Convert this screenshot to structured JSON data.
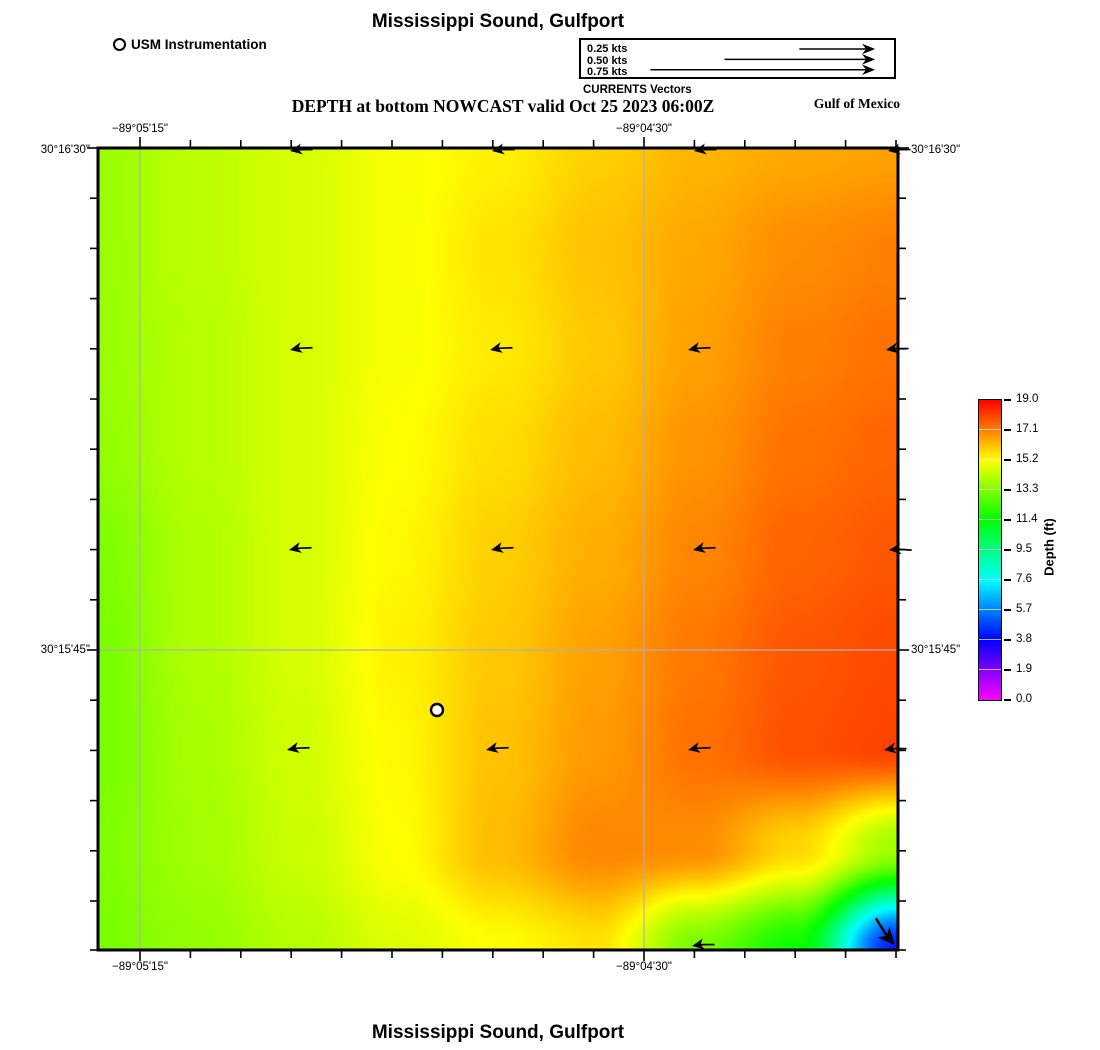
{
  "figure": {
    "title_top": "Mississippi Sound, Gulfport",
    "title_bottom": "Mississippi Sound, Gulfport",
    "nowcast_title": "DEPTH at bottom NOWCAST valid Oct 25 2023 06:00Z",
    "region_label": "Gulf of Mexico"
  },
  "instrumentation_legend": {
    "label": "USM Instrumentation",
    "marker": "open-circle-icon"
  },
  "currents_legend": {
    "caption": "CURRENTS Vectors",
    "items": [
      {
        "label": "0.25 kts",
        "arrow_length_px": 84
      },
      {
        "label": "0.50 kts",
        "arrow_length_px": 167
      },
      {
        "label": "0.75 kts",
        "arrow_length_px": 249
      }
    ]
  },
  "axes": {
    "top": [
      {
        "text": "−89°05'15\"",
        "x": 140
      },
      {
        "text": "−89°04'30\"",
        "x": 644
      }
    ],
    "bottom": [
      {
        "text": "−89°05'15\"",
        "x": 140
      },
      {
        "text": "−89°04'30\"",
        "x": 644
      }
    ],
    "left": [
      {
        "text": "30°16'30\"",
        "y": 150
      },
      {
        "text": "30°15'45\"",
        "y": 650
      }
    ],
    "right": [
      {
        "text": "30°16'30\"",
        "y": 150
      },
      {
        "text": "30°15'45\"",
        "y": 650
      }
    ]
  },
  "colorbar": {
    "label": "Depth (ft)",
    "min": 0,
    "max": 19,
    "tick_labels": [
      "19.0",
      "17.1",
      "15.2",
      "13.3",
      "11.4",
      "9.5",
      "7.6",
      "5.7",
      "3.8",
      "1.9",
      "0.0"
    ],
    "colormap": "rainbow: magenta(0) - blue(3.8) - cyan(7.6) - green(11.4) - yellow(15.2) - red(19.0)"
  },
  "chart_data": {
    "type": "heatmap",
    "title": "Mississippi Sound, Gulfport",
    "subtitle": "DEPTH at bottom NOWCAST valid Oct 25 2023 06:00Z",
    "units": "ft",
    "value_range": [
      0,
      19
    ],
    "depth_grid_ft": [
      [
        13.7,
        14.2,
        14.6,
        15.1,
        15.4,
        15.9,
        16.3,
        16.5,
        16.6
      ],
      [
        13.7,
        14.2,
        14.6,
        15.1,
        15.6,
        16.1,
        16.5,
        16.9,
        17.1
      ],
      [
        13.7,
        14.1,
        14.6,
        15.1,
        15.5,
        16.0,
        16.6,
        17.1,
        17.3
      ],
      [
        13.6,
        14.1,
        14.6,
        15.2,
        15.7,
        16.2,
        16.8,
        17.3,
        17.5
      ],
      [
        13.3,
        14.0,
        14.6,
        15.3,
        15.9,
        16.4,
        17.0,
        17.5,
        17.7
      ],
      [
        13.2,
        14.0,
        14.6,
        15.4,
        16.0,
        16.6,
        17.2,
        17.7,
        17.9
      ],
      [
        13.2,
        13.9,
        14.5,
        15.3,
        16.1,
        16.7,
        17.3,
        17.8,
        18.0
      ],
      [
        13.3,
        13.8,
        14.4,
        15.2,
        16.2,
        17.0,
        16.9,
        15.8,
        13.8
      ],
      [
        13.2,
        13.6,
        14.1,
        14.7,
        15.2,
        15.6,
        13.2,
        11.6,
        4.2
      ]
    ],
    "grid_rows_north_to_south": true,
    "station": {
      "name": "USM Instrumentation",
      "x_px": 339,
      "y_px": 562
    },
    "current_vectors": {
      "flow_direction": "westward (arrows point left); southeastward at bottom-right corner",
      "arrows": [
        [
          192,
          3,
          170,
          1
        ],
        [
          394,
          3,
          170,
          1
        ],
        [
          596,
          3,
          170,
          1
        ],
        [
          790,
          3,
          170,
          1
        ],
        [
          192,
          202,
          168,
          1
        ],
        [
          392,
          202,
          168,
          1
        ],
        [
          590,
          202,
          168,
          1
        ],
        [
          788,
          202,
          170,
          1
        ],
        [
          191,
          402,
          168,
          1
        ],
        [
          393,
          402,
          168,
          1
        ],
        [
          595,
          402,
          168,
          1
        ],
        [
          791,
          402,
          174,
          1
        ],
        [
          189,
          602,
          168,
          1
        ],
        [
          388,
          602,
          168,
          1
        ],
        [
          590,
          602,
          168,
          1
        ],
        [
          786,
          602,
          170,
          1
        ],
        [
          594,
          798,
          170,
          1
        ],
        [
          797,
          797,
          48,
          1.45
        ]
      ]
    },
    "gridlines": {
      "vertical_x_px": [
        42,
        546
      ],
      "horizontal_y_px": [
        502
      ]
    }
  }
}
